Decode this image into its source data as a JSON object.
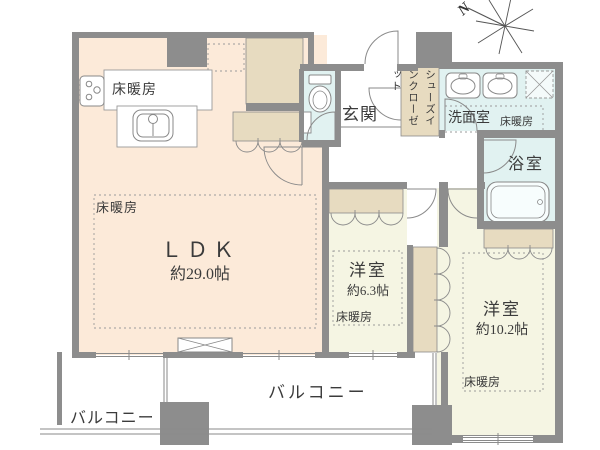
{
  "compass": {
    "north_label": "N"
  },
  "rooms": {
    "ldk": {
      "name": "ＬＤＫ",
      "size": "約29.0帖",
      "floor_heating": "床暖房",
      "kitchen_floor_heating": "床暖房"
    },
    "bedroom1": {
      "name": "洋室",
      "size": "約6.3帖",
      "floor_heating": "床暖房"
    },
    "bedroom2": {
      "name": "洋室",
      "size": "約10.2帖",
      "floor_heating": "床暖房"
    },
    "entrance": {
      "name": "玄関"
    },
    "shoe_closet": {
      "name": "シューズインクローゼット"
    },
    "washroom": {
      "name": "洗面室",
      "floor_heating": "床暖房"
    },
    "bathroom": {
      "name": "浴室"
    },
    "balcony_left": {
      "name": "バルコニー"
    },
    "balcony_main": {
      "name": "バルコニー"
    }
  },
  "colors": {
    "wall": "#8d8d8d",
    "ldk_floor": "#fcead9",
    "bedroom_floor": "#f5f5e3",
    "closet": "#e7dbc0",
    "wet_area": "#e1f2f1",
    "line": "#8a8a8a",
    "text": "#3b3b3b"
  }
}
